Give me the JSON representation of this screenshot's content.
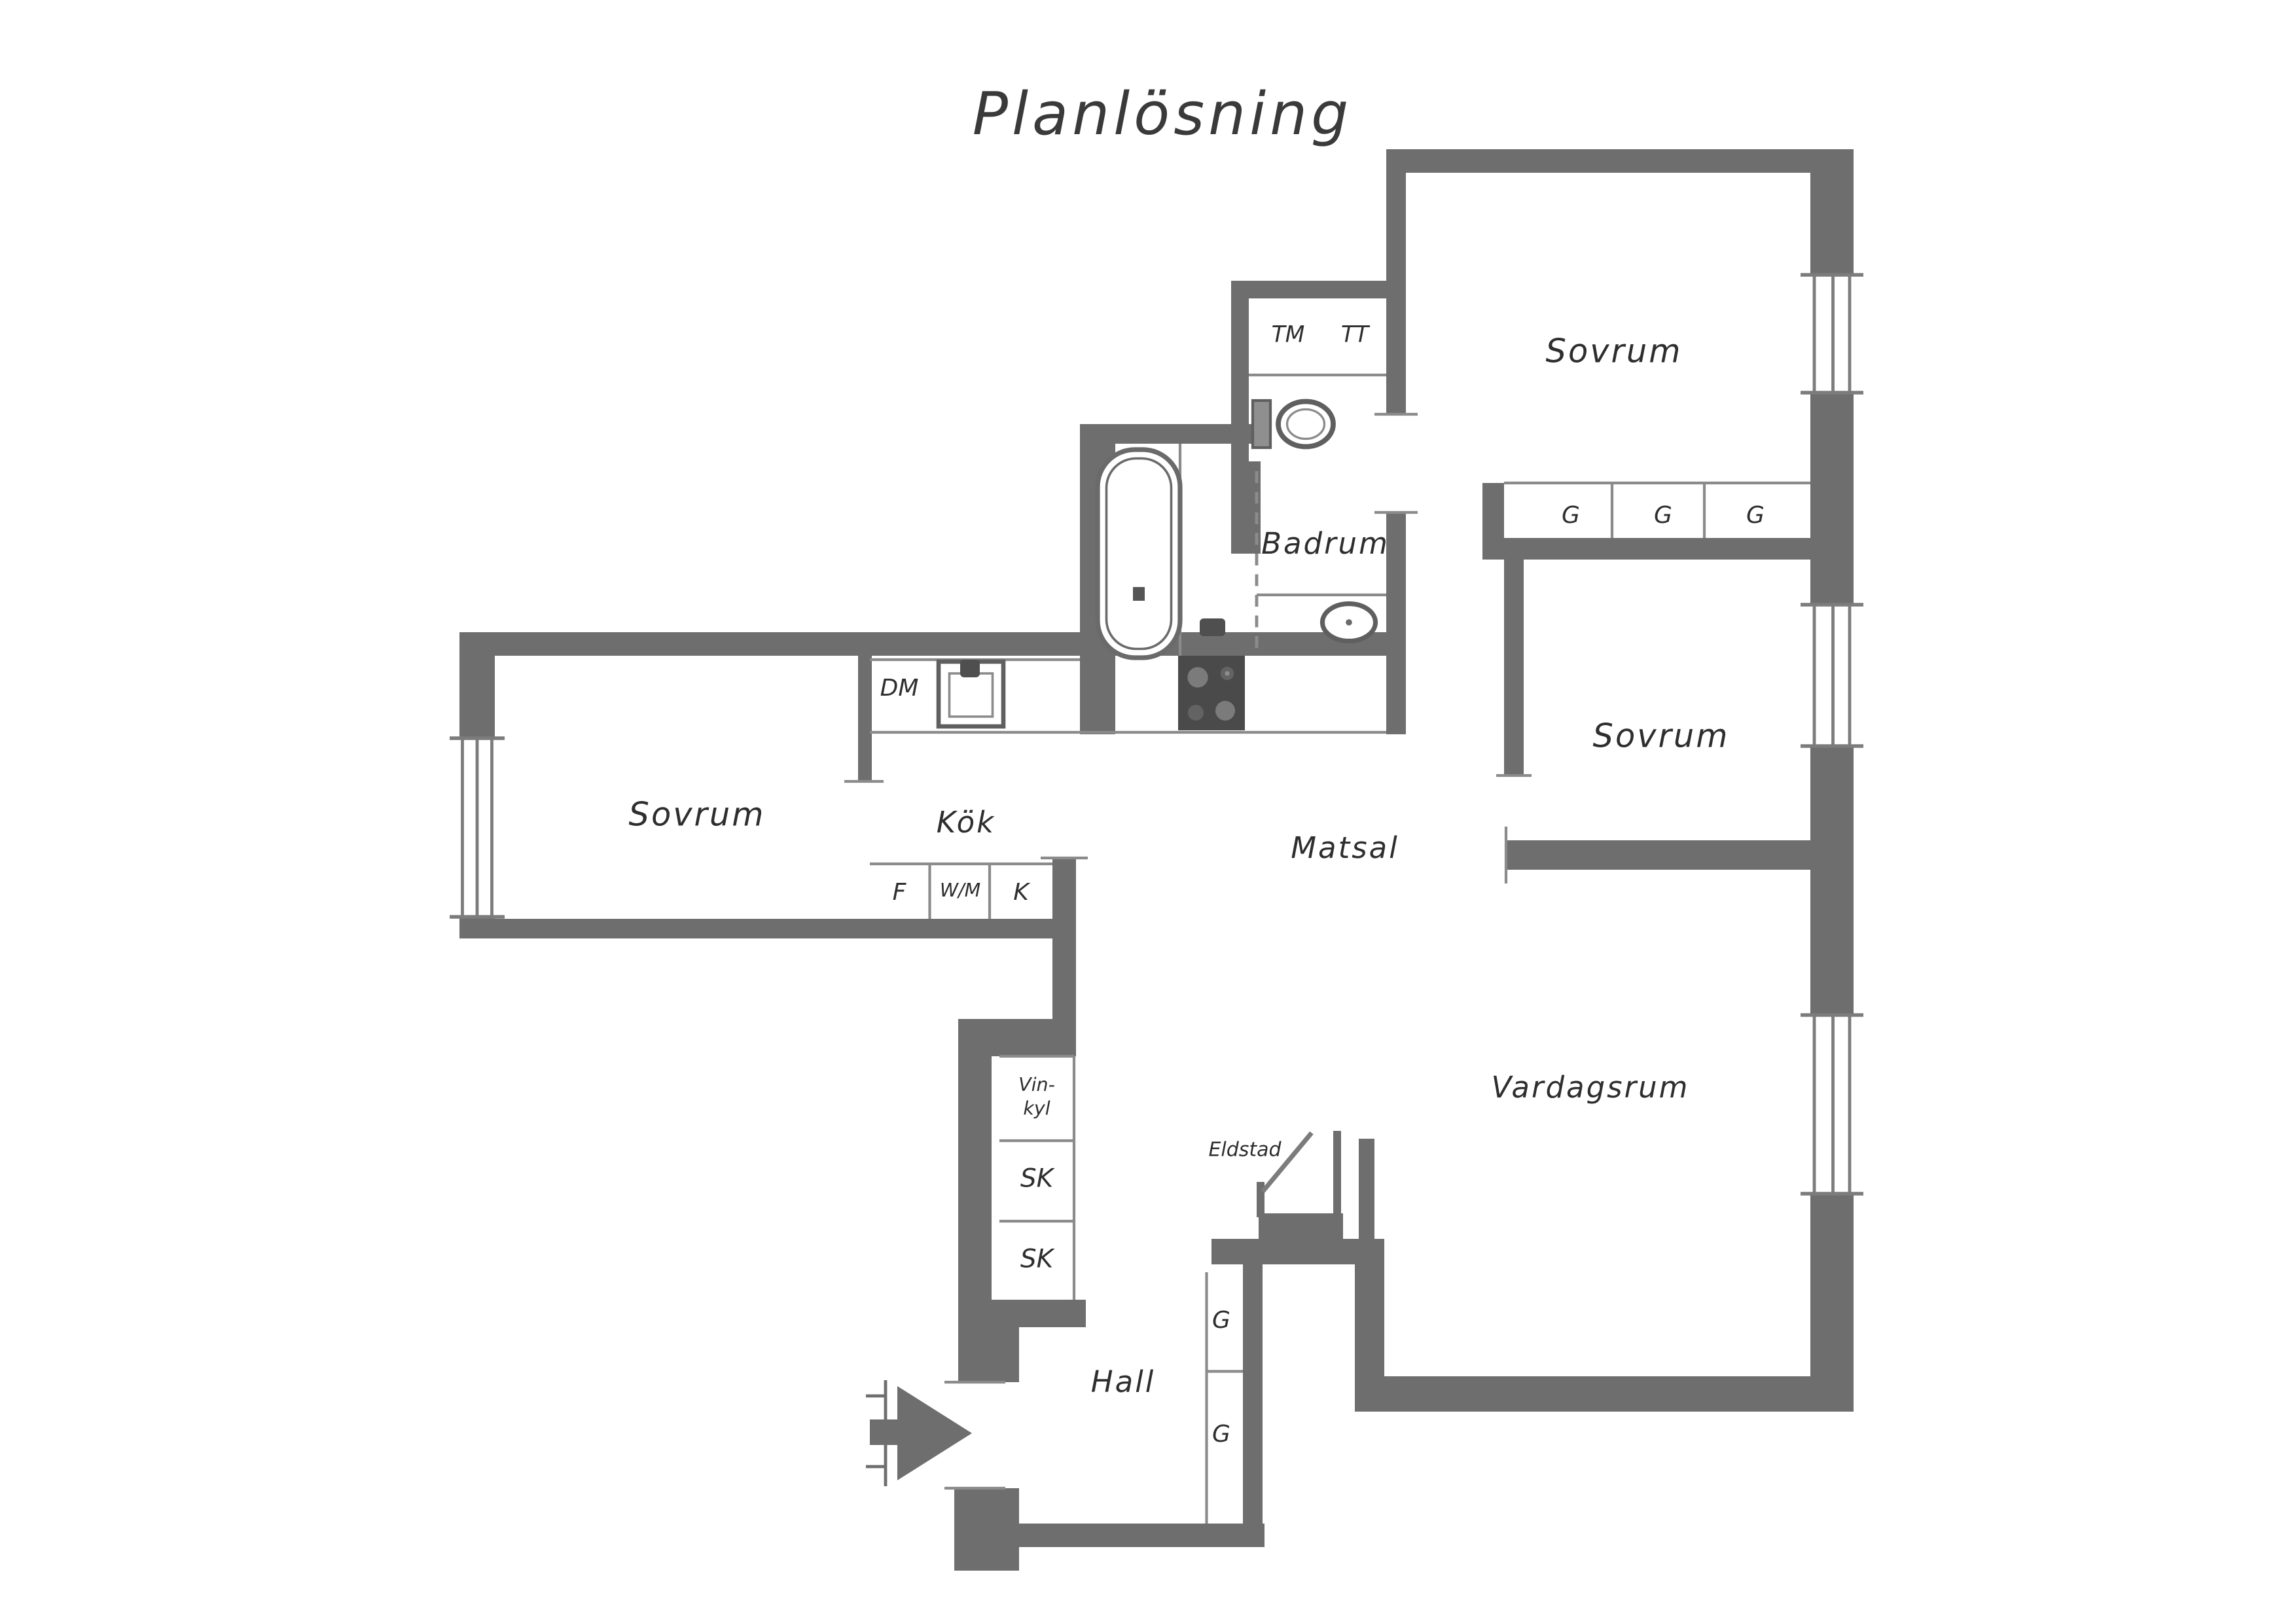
{
  "title": "Planlösning",
  "rooms": {
    "bedroom_top": "Sovrum",
    "bedroom_middle": "Sovrum",
    "bedroom_left": "Sovrum",
    "bathroom": "Badrum",
    "kitchen": "Kök",
    "dining_room": "Matsal",
    "living_room": "Vardagsrum",
    "hall": "Hall"
  },
  "fixtures": {
    "washing_machine": "TM",
    "tumble_dryer": "TT",
    "dishwasher": "DM",
    "fridge": "F",
    "washer_middle": "W/M",
    "freezer": "K",
    "wine_fridge_line1": "Vin-",
    "wine_fridge_line2": "kyl",
    "closet_upper": "SK",
    "closet_lower": "SK",
    "fireplace": "Eldstad"
  },
  "wardrobes": {
    "bedroom_row": [
      "G",
      "G",
      "G"
    ],
    "hall_column": [
      "G",
      "G"
    ]
  },
  "colors": {
    "wall": "#6e6e6e",
    "thin_line": "#8b8b8b",
    "text": "#2e2e2e",
    "appliance_dark": "#4a4a4a",
    "background": "#ffffff"
  }
}
